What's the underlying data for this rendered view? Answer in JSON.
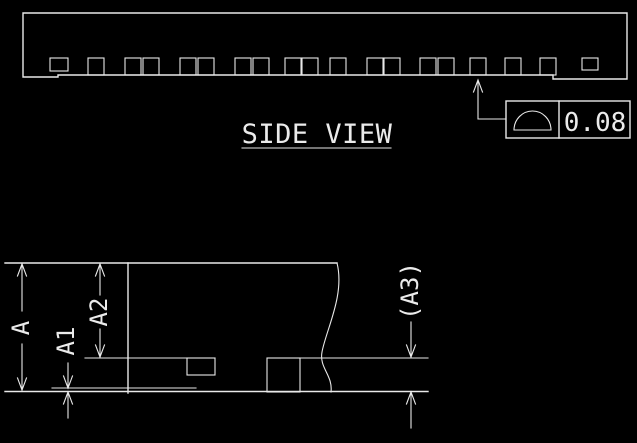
{
  "colors": {
    "background": "#000000",
    "line": "#e9e9e9"
  },
  "side_view": {
    "title": "SIDE VIEW",
    "teeth_x": [
      88,
      125,
      143,
      180,
      198,
      235,
      253,
      285,
      302,
      330,
      367,
      384,
      420,
      438,
      470,
      505,
      540
    ],
    "tolerance_callout": {
      "symbol": "profile-of-a-surface",
      "value": "0.08"
    }
  },
  "detail_view": {
    "dimensions": [
      {
        "label": "A"
      },
      {
        "label": "A1"
      },
      {
        "label": "A2"
      },
      {
        "label": "(A3)"
      }
    ]
  }
}
